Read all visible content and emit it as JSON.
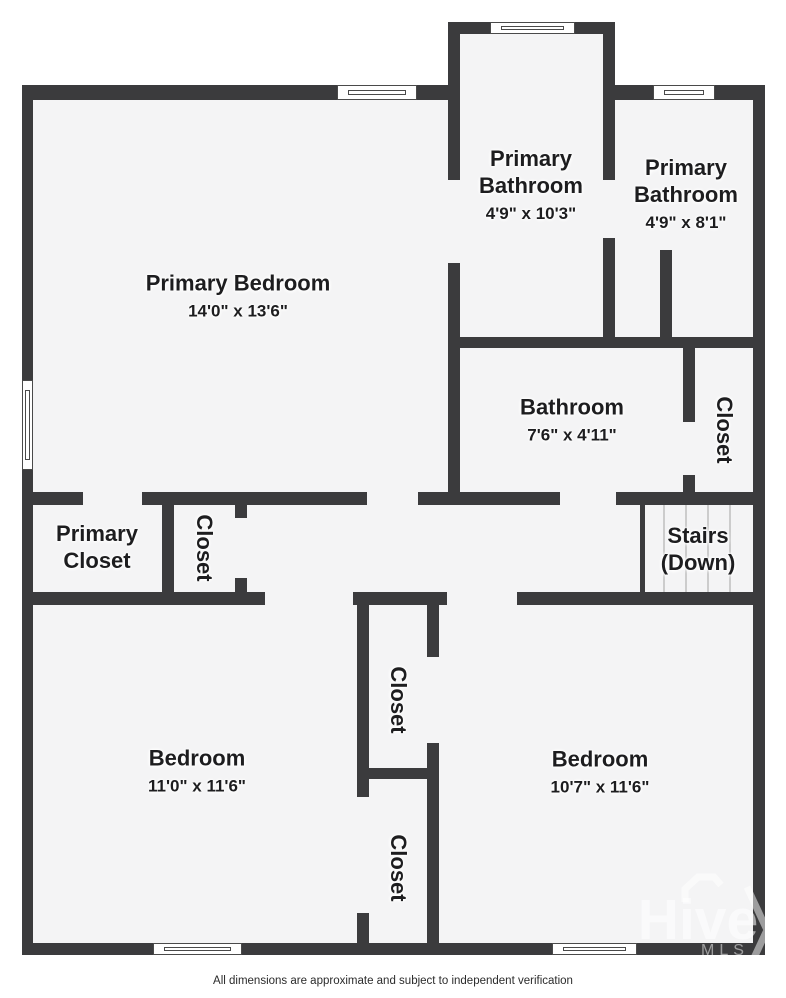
{
  "colors": {
    "wall": "#3b3b3d",
    "floor": "#f4f4f5",
    "label": "#1d1d1f",
    "window_frame": "#4a4a4a",
    "stair_tread": "#cccccc",
    "background": "#ffffff"
  },
  "rooms": [
    {
      "id": "primary-bedroom",
      "label": "Primary Bedroom",
      "dims": "14'0\" x 13'6\""
    },
    {
      "id": "primary-bathroom-1",
      "label": "Primary Bathroom",
      "dims": "4'9\" x 10'3\""
    },
    {
      "id": "primary-bathroom-2",
      "label": "Primary Bathroom",
      "dims": "4'9\" x 8'1\""
    },
    {
      "id": "bathroom",
      "label": "Bathroom",
      "dims": "7'6\" x 4'11\""
    },
    {
      "id": "closet-bathroom-side",
      "label": "Closet"
    },
    {
      "id": "primary-closet",
      "label": "Primary Closet"
    },
    {
      "id": "closet-hallway",
      "label": "Closet"
    },
    {
      "id": "stairs",
      "label": "Stairs (Down)"
    },
    {
      "id": "bedroom-left",
      "label": "Bedroom",
      "dims": "11'0\" x 11'6\""
    },
    {
      "id": "closet-middle-top",
      "label": "Closet"
    },
    {
      "id": "closet-middle-bottom",
      "label": "Closet"
    },
    {
      "id": "bedroom-right",
      "label": "Bedroom",
      "dims": "10'7\" x 11'6\""
    }
  ],
  "watermark": {
    "brand": "Hive",
    "sub": "MLS"
  },
  "footer": {
    "disclaimer": "All dimensions are approximate and subject to independent verification"
  }
}
